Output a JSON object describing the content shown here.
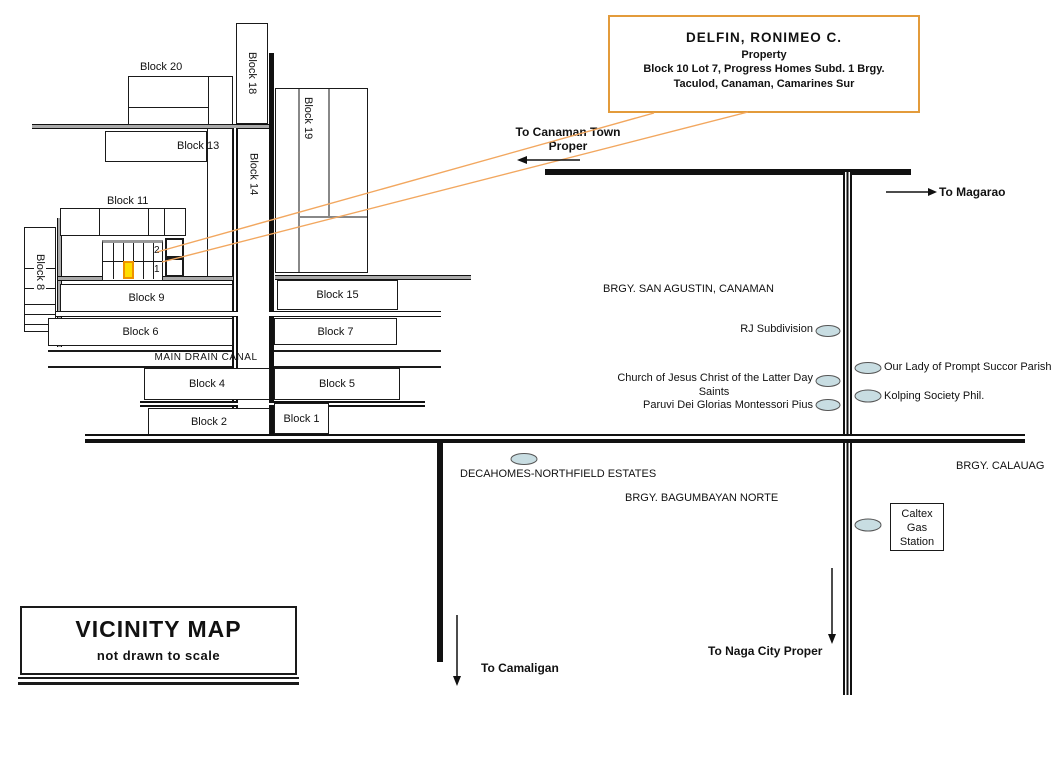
{
  "callout": {
    "title": "DELFIN, RONIMEO  C.",
    "line2": "Property",
    "line3": "Block 10 Lot 7, Progress Homes Subd. 1 Brgy.",
    "line4": "Taculod, Canaman, Camarines Sur"
  },
  "legend": {
    "title": "VICINITY MAP",
    "subtitle": "not drawn to scale"
  },
  "blocks": {
    "b20": "Block 20",
    "b18": "Block 18",
    "b13": "Block 13",
    "b14": "Block 14",
    "b19": "Block 19",
    "b11": "Block 11",
    "b8": "Block 8",
    "b9": "Block 9",
    "b6": "Block 6",
    "b15": "Block 15",
    "b7": "Block 7",
    "b4": "Block 4",
    "b5": "Block 5",
    "b2": "Block 2",
    "b1": "Block 1"
  },
  "lot": {
    "upper": "2",
    "lower": "1"
  },
  "canal": {
    "label": "MAIN DRAIN CANAL"
  },
  "directions": {
    "canaman": "To Canaman Town Proper",
    "magarao": "To Magarao",
    "naga": "To Naga City Proper",
    "camaligan": "To Camaligan"
  },
  "areas": {
    "san_agustin": "BRGY. SAN AGUSTIN, CANAMAN",
    "bagumbayan": "BRGY. BAGUMBAYAN NORTE",
    "calauag": "BRGY. CALAUAG"
  },
  "landmarks": {
    "rj": "RJ Subdivision",
    "lds_line1": "Church of Jesus Christ of the Latter Day",
    "lds_line2": "Saints",
    "paruvi": "Paruvi Dei Glorias Montessori Pius",
    "our_lady": "Our Lady of Prompt Succor Parish",
    "kolping": "Kolping Society Phil.",
    "decahomes": "DECAHOMES-NORTHFIELD ESTATES",
    "caltex_line1": "Caltex",
    "caltex_line2": "Gas",
    "caltex_line3": "Station"
  },
  "colors": {
    "callout_border": "#E39B3B",
    "leader": "#F2A75F",
    "lot_fill": "#FFDD00",
    "lot_border": "#EE9200",
    "marker_fill": "#C8DDE2",
    "road": "#111111"
  }
}
